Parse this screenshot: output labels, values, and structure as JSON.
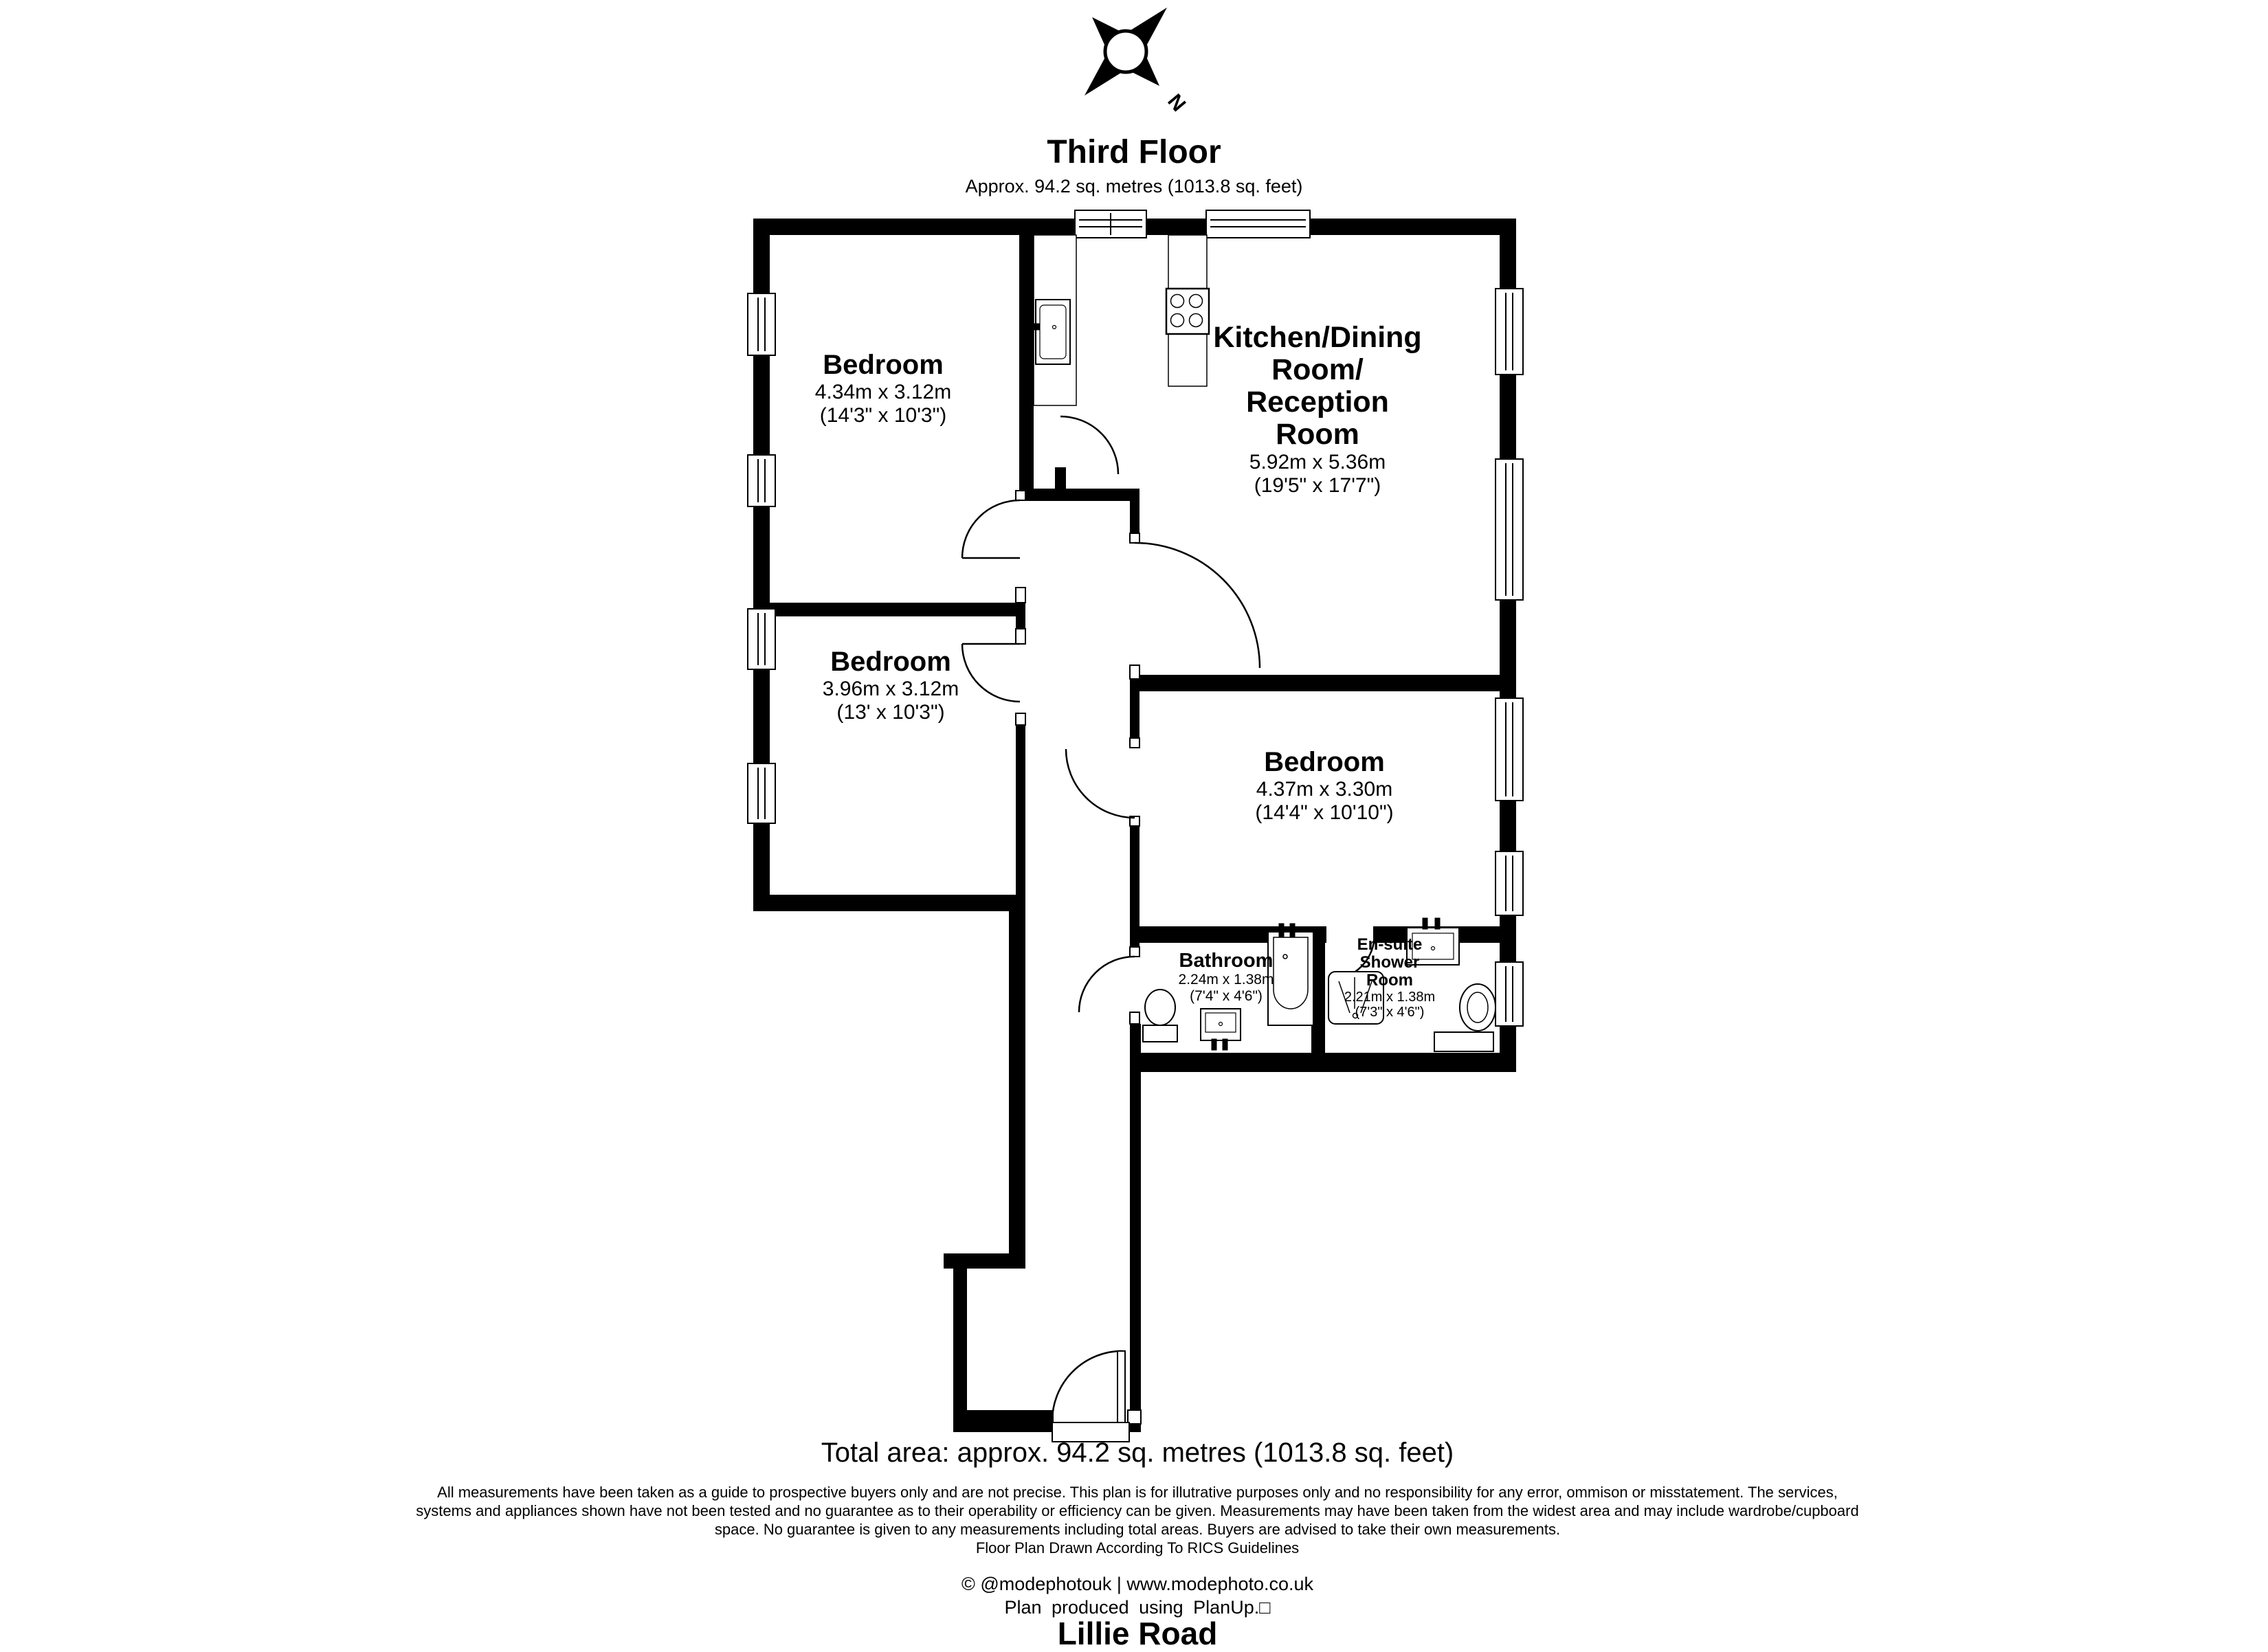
{
  "header": {
    "title": "Third Floor",
    "subtitle": "Approx. 94.2 sq. metres (1013.8 sq. feet)",
    "compass_label": "N"
  },
  "rooms": [
    {
      "name_lines": [
        "Bedroom"
      ],
      "dims_metric": "4.34m x 3.12m",
      "dims_imperial": "(14'3\" x 10'3\")"
    },
    {
      "name_lines": [
        "Kitchen/Dining",
        "Room/",
        "Reception",
        "Room"
      ],
      "dims_metric": "5.92m x 5.36m",
      "dims_imperial": "(19'5\" x 17'7\")"
    },
    {
      "name_lines": [
        "Bedroom"
      ],
      "dims_metric": "3.96m x 3.12m",
      "dims_imperial": "(13' x 10'3\")"
    },
    {
      "name_lines": [
        "Bedroom"
      ],
      "dims_metric": "4.37m x 3.30m",
      "dims_imperial": "(14'4\" x 10'10\")"
    },
    {
      "name_lines": [
        "Bathroom"
      ],
      "dims_metric": "2.24m x 1.38m",
      "dims_imperial": "(7'4\" x 4'6\")"
    },
    {
      "name_lines": [
        "En-suite",
        "Shower",
        "Room"
      ],
      "dims_metric": "2.21m x 1.38m",
      "dims_imperial": "(7'3\" x 4'6\")"
    }
  ],
  "footer": {
    "total_area": "Total area: approx. 94.2 sq. metres (1013.8 sq. feet)",
    "disclaimer_lines": [
      "All measurements have been taken as a guide to prospective buyers only and are not precise. This plan is for illutrative purposes only and no responsibility for any error, ommison or misstatement. The services,",
      "systems and appliances shown have not been tested and no guarantee as to their operability or efficiency can be given. Measurements may have been taken from the widest area and may include wardrobe/cupboard",
      "space. No guarantee is given to any measurements including total areas. Buyers are advised to take their own measurements."
    ],
    "rics": "Floor Plan Drawn According To RICS Guidelines",
    "credit": "© @modephotouk | www.modephoto.co.uk",
    "produced": "Plan produced using PlanUp.□",
    "address": "Lillie Road"
  }
}
